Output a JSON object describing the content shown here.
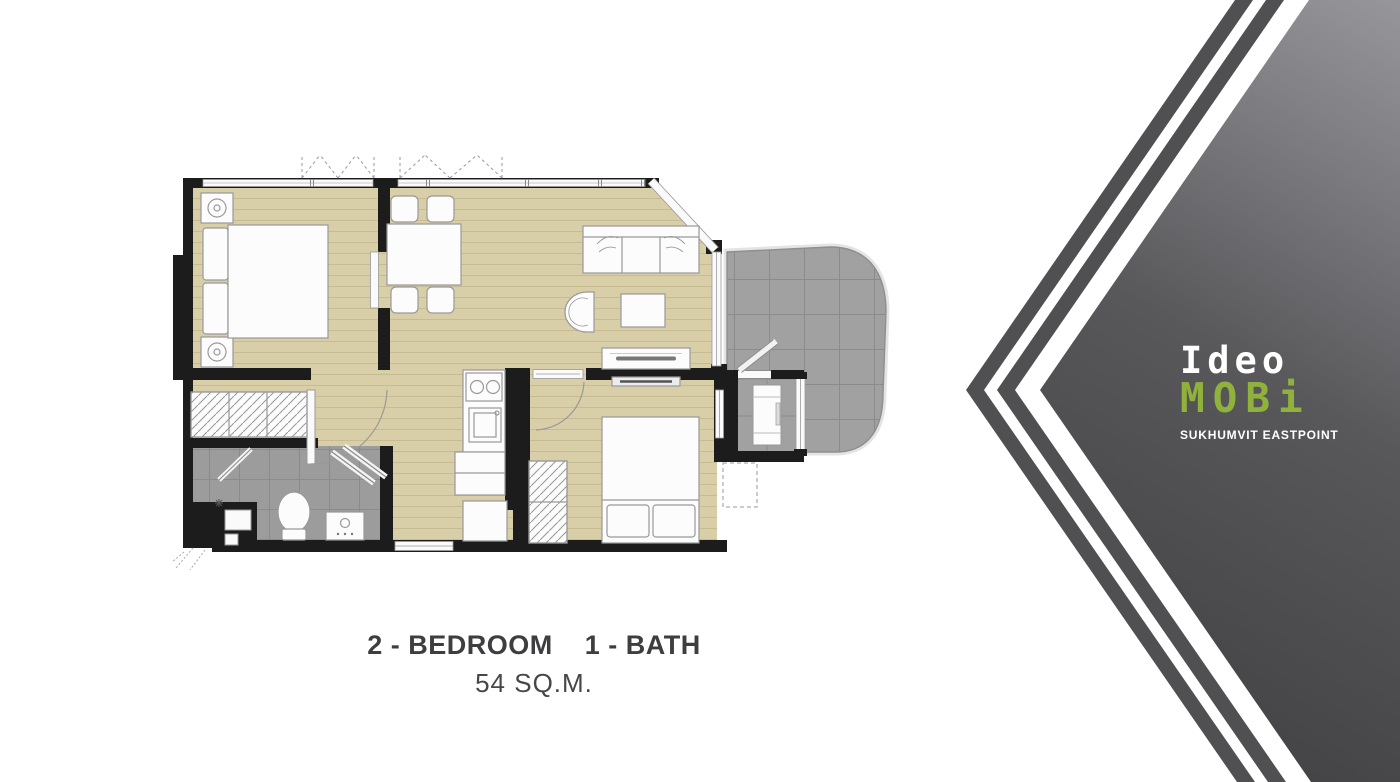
{
  "floorplan": {
    "caption": {
      "bedrooms": "2 - BEDROOM",
      "baths": "1 - BATH",
      "area": "54 SQ.M."
    },
    "rooms": [
      "bedroom-1",
      "dining",
      "living",
      "kitchen",
      "hallway",
      "bathroom",
      "bedroom-2",
      "balcony",
      "ac-ledge"
    ]
  },
  "brand": {
    "name_line1": "Ideo",
    "name_line2": "MOBi",
    "subtitle": "SUKHUMVIT EASTPOINT"
  },
  "colors": {
    "wood": "#d8cfa9",
    "wood-line": "#c6bb93",
    "tile": "#a1a1a1",
    "tile-line": "#8b8b8b",
    "bath-tile": "#9c9c9c",
    "wall": "#1c1c1c",
    "furniture": "#fcfcfc",
    "furniture-line": "#999999",
    "brand-green": "#90b23d",
    "panel-dark": "#454548",
    "panel-mid": "#58585b",
    "panel-light": "#97979b",
    "stripe": "#505053",
    "caption-text": "#3e3e40"
  }
}
